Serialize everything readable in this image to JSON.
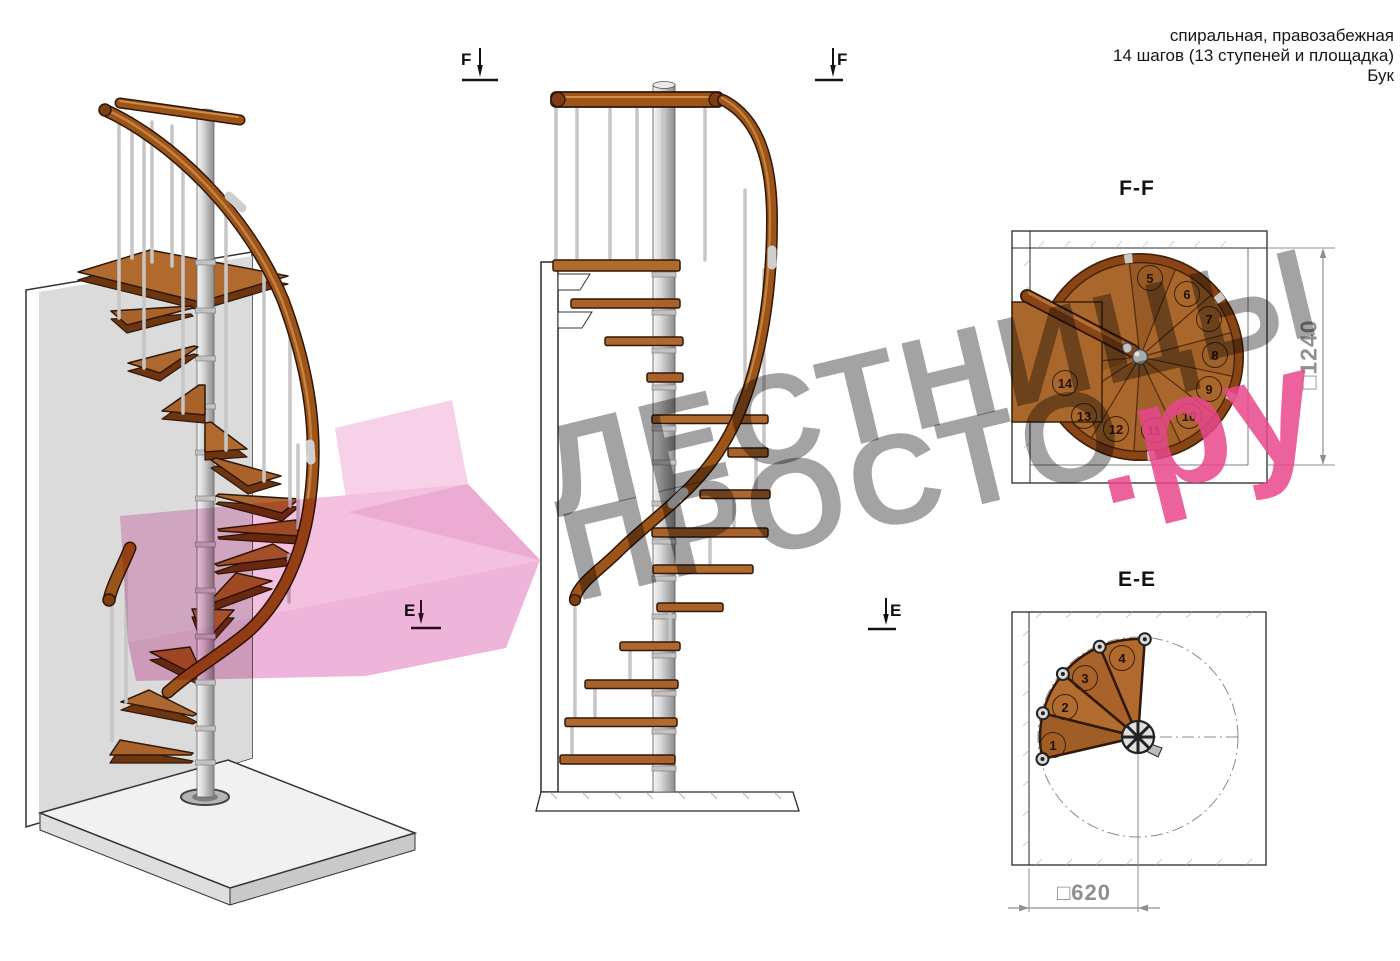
{
  "title_block": {
    "type_line": "спиральная, правозабежная",
    "steps_line": "14 шагов (13 ступеней и площадка)",
    "material_line": "Бук"
  },
  "watermark": {
    "word1": "ЛЕСТНИЦЫ",
    "word2": "ПРОСТО",
    "suffix": ".ру",
    "gray": "#9e9e9e",
    "pink": "#e8478c"
  },
  "markers": {
    "f_label": "F",
    "e_label": "E"
  },
  "plan_ff": {
    "title": "F-F",
    "dim_symbol": "□",
    "dimension": "1240",
    "step_numbers": [
      5,
      6,
      7,
      8,
      9,
      10,
      11,
      12,
      13,
      14
    ]
  },
  "plan_ee": {
    "title": "E-E",
    "dim_symbol": "□",
    "dimension": "620",
    "step_numbers": [
      1,
      2,
      3,
      4
    ]
  },
  "colors": {
    "wood": "#a8622a",
    "handrail": "#9c5418",
    "metal": "#c6c6c6",
    "dimension_gray": "#8f8f8f"
  }
}
